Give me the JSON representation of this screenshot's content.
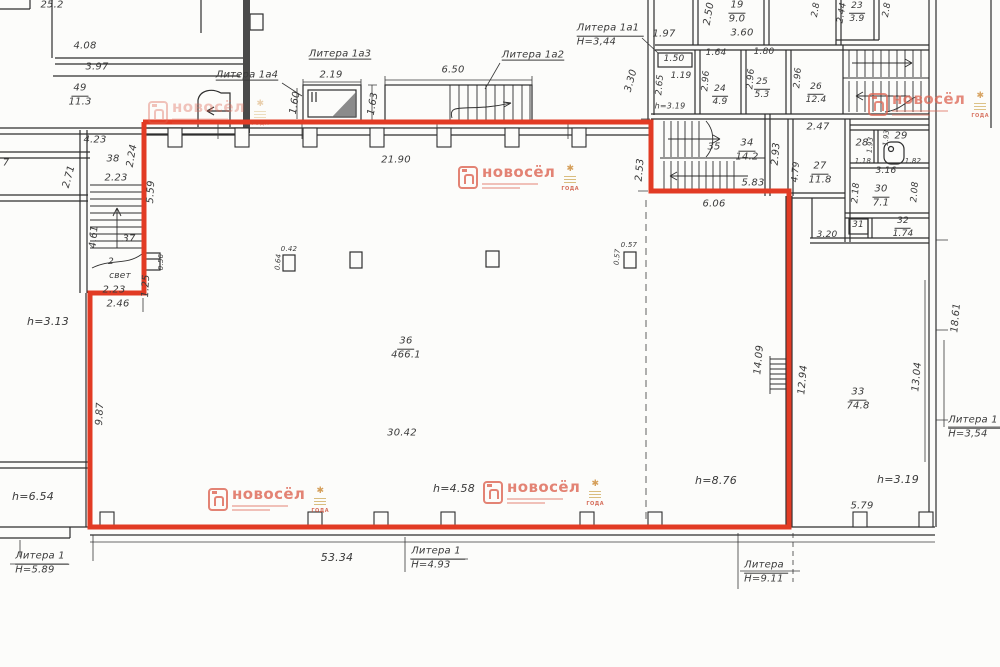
{
  "colors": {
    "red_outline": "#e23b24",
    "wall": "#2e2e2e",
    "watermark": "#dd6553",
    "badge_gold": "#c79b3b"
  },
  "watermark": {
    "brand": "новосёл",
    "badge": "ГОДА"
  },
  "labels": [
    {
      "text": "25.2",
      "x": 52,
      "y": 6
    },
    {
      "text": "4.08",
      "x": 85,
      "y": 47
    },
    {
      "text": "3.97",
      "x": 97,
      "y": 68
    },
    {
      "num": "49",
      "den": "11.3",
      "x": 80,
      "y": 96,
      "n": "room-area-label"
    },
    {
      "text": "4.23",
      "x": 95,
      "y": 141
    },
    {
      "text": "2.71",
      "x": 70,
      "y": 177,
      "r": -75
    },
    {
      "text": "7",
      "x": 6,
      "y": 164
    },
    {
      "text": "h=3.13",
      "x": 48,
      "y": 322,
      "s": 11,
      "n": "height-label"
    },
    {
      "text": "h=6.54",
      "x": 33,
      "y": 497,
      "s": 11,
      "n": "height-label"
    },
    {
      "num": "Литера 1",
      "den": "Н=5.89",
      "x": 42,
      "y": 564,
      "lit": true,
      "n": "litera-label"
    },
    {
      "text": "38",
      "x": 113,
      "y": 160,
      "n": "room-number"
    },
    {
      "text": "2.23",
      "x": 116,
      "y": 179
    },
    {
      "text": "2.24",
      "x": 133,
      "y": 156,
      "r": -80
    },
    {
      "text": "5.59",
      "x": 152,
      "y": 192,
      "r": -87
    },
    {
      "text": "4.61",
      "x": 95,
      "y": 237,
      "r": -85
    },
    {
      "text": "37",
      "x": 129,
      "y": 240,
      "n": "room-number"
    },
    {
      "text": "2",
      "x": 111,
      "y": 263,
      "s": 9
    },
    {
      "text": "свет",
      "x": 120,
      "y": 277,
      "s": 9
    },
    {
      "text": "2.23",
      "x": 114,
      "y": 291
    },
    {
      "text": "0.56",
      "x": 162,
      "y": 262,
      "r": -90,
      "s": 7
    },
    {
      "text": "1.25",
      "x": 147,
      "y": 286,
      "r": -87
    },
    {
      "text": "2.46",
      "x": 118,
      "y": 305
    },
    {
      "text": "9.87",
      "x": 101,
      "y": 414,
      "r": -87
    },
    {
      "text": "Литера 1а4",
      "x": 247,
      "y": 76,
      "u": true,
      "n": "litera-label"
    },
    {
      "text": "2.19",
      "x": 331,
      "y": 76
    },
    {
      "text": "1.60",
      "x": 296,
      "y": 103,
      "r": -80
    },
    {
      "text": "Литера 1а3",
      "x": 340,
      "y": 55,
      "u": true,
      "n": "litera-label"
    },
    {
      "text": "1.63",
      "x": 374,
      "y": 104,
      "r": -80
    },
    {
      "text": "6.50",
      "x": 453,
      "y": 71
    },
    {
      "text": "Литера 1а2",
      "x": 533,
      "y": 56,
      "u": true,
      "n": "litera-label"
    },
    {
      "text": "21.90",
      "x": 396,
      "y": 161
    },
    {
      "num": "Литера 1а1",
      "den": "Н=3,44",
      "x": 610,
      "y": 36,
      "lit": true,
      "n": "litera-label"
    },
    {
      "text": "1.97",
      "x": 664,
      "y": 35
    },
    {
      "text": "3.30",
      "x": 632,
      "y": 81,
      "r": -75
    },
    {
      "text": "2.50",
      "x": 710,
      "y": 14,
      "r": -80
    },
    {
      "num": "19",
      "den": "9.0",
      "x": 737,
      "y": 13,
      "n": "room-area-label"
    },
    {
      "text": "3.60",
      "x": 742,
      "y": 34
    },
    {
      "text": "2.8",
      "x": 817,
      "y": 10,
      "r": -80,
      "s": 9
    },
    {
      "text": "2.44",
      "x": 843,
      "y": 13,
      "r": -80,
      "s": 9
    },
    {
      "num": "23",
      "den": "3.9",
      "x": 857,
      "y": 13,
      "s": 9,
      "n": "room-area-label"
    },
    {
      "text": "2.8",
      "x": 888,
      "y": 10,
      "r": -80,
      "s": 9
    },
    {
      "text": "1.50",
      "x": 674,
      "y": 60,
      "s": 9
    },
    {
      "text": "1.19",
      "x": 681,
      "y": 77,
      "s": 9
    },
    {
      "text": "2.65",
      "x": 661,
      "y": 85,
      "r": -85,
      "s": 9
    },
    {
      "text": "h=3.19",
      "x": 670,
      "y": 107,
      "s": 8,
      "n": "height-label"
    },
    {
      "text": "1.64",
      "x": 716,
      "y": 54,
      "s": 9
    },
    {
      "text": "2.96",
      "x": 707,
      "y": 81,
      "r": -85,
      "s": 9
    },
    {
      "num": "24",
      "den": "4.9",
      "x": 720,
      "y": 96,
      "s": 9,
      "n": "room-area-label"
    },
    {
      "text": "1.80",
      "x": 764,
      "y": 53,
      "s": 9
    },
    {
      "text": "2.96",
      "x": 752,
      "y": 79,
      "r": -85,
      "s": 9
    },
    {
      "num": "25",
      "den": "5.3",
      "x": 762,
      "y": 89,
      "s": 9,
      "n": "room-area-label"
    },
    {
      "text": "2.96",
      "x": 799,
      "y": 78,
      "r": -85,
      "s": 9
    },
    {
      "num": "26",
      "den": "12.4",
      "x": 816,
      "y": 94,
      "s": 9,
      "n": "room-area-label"
    },
    {
      "text": "2.47",
      "x": 818,
      "y": 128
    },
    {
      "text": "35",
      "x": 714,
      "y": 148,
      "n": "room-number"
    },
    {
      "num": "34",
      "den": "14.2",
      "x": 747,
      "y": 151,
      "n": "room-area-label"
    },
    {
      "text": "2.93",
      "x": 777,
      "y": 154,
      "r": -85
    },
    {
      "text": "4.79",
      "x": 797,
      "y": 172,
      "r": -85,
      "s": 9
    },
    {
      "num": "27",
      "den": "11.8",
      "x": 820,
      "y": 174,
      "n": "room-area-label"
    },
    {
      "text": "5.83",
      "x": 753,
      "y": 184
    },
    {
      "text": "6.06",
      "x": 714,
      "y": 205
    },
    {
      "text": "28",
      "x": 862,
      "y": 144,
      "n": "room-number"
    },
    {
      "text": "1.93",
      "x": 871,
      "y": 145,
      "r": -85,
      "s": 7
    },
    {
      "text": "1.93",
      "x": 887,
      "y": 138,
      "r": -85,
      "s": 7
    },
    {
      "text": "29",
      "x": 901,
      "y": 137,
      "n": "room-number"
    },
    {
      "text": "1.18",
      "x": 863,
      "y": 162,
      "s": 7
    },
    {
      "text": "1.82",
      "x": 913,
      "y": 162,
      "s": 7
    },
    {
      "text": "3.16",
      "x": 886,
      "y": 172,
      "s": 9
    },
    {
      "text": "2.18",
      "x": 857,
      "y": 193,
      "r": -85,
      "s": 9
    },
    {
      "num": "30",
      "den": "7.1",
      "x": 881,
      "y": 197,
      "n": "room-area-label"
    },
    {
      "text": "2.08",
      "x": 916,
      "y": 192,
      "r": -85,
      "s": 9
    },
    {
      "text": "31",
      "x": 858,
      "y": 226,
      "s": 9,
      "n": "room-number"
    },
    {
      "num": "32",
      "den": "1.74",
      "x": 903,
      "y": 228,
      "s": 9,
      "n": "room-area-label"
    },
    {
      "text": "3.20",
      "x": 827,
      "y": 236,
      "s": 9
    },
    {
      "text": "18.61",
      "x": 957,
      "y": 318,
      "r": -85
    },
    {
      "text": "13.04",
      "x": 918,
      "y": 377,
      "r": -85
    },
    {
      "num": "33",
      "den": "74.8",
      "x": 858,
      "y": 400,
      "n": "room-area-label"
    },
    {
      "text": "14.09",
      "x": 760,
      "y": 360,
      "r": -85
    },
    {
      "text": "12.94",
      "x": 804,
      "y": 380,
      "r": -85
    },
    {
      "num": "Литера 1",
      "den": "Н=3,54",
      "x": 975,
      "y": 428,
      "lit": true,
      "n": "litera-label"
    },
    {
      "text": "h=3.19",
      "x": 898,
      "y": 480,
      "s": 11,
      "n": "height-label"
    },
    {
      "text": "5.79",
      "x": 862,
      "y": 507
    },
    {
      "text": "h=8.76",
      "x": 716,
      "y": 481,
      "s": 11,
      "n": "height-label"
    },
    {
      "num": "36",
      "den": "466.1",
      "x": 406,
      "y": 349,
      "n": "room-area-label"
    },
    {
      "text": "30.42",
      "x": 402,
      "y": 434
    },
    {
      "text": "h=4.58",
      "x": 454,
      "y": 489,
      "s": 11,
      "n": "height-label"
    },
    {
      "text": "0.42",
      "x": 289,
      "y": 250,
      "s": 7
    },
    {
      "text": "0.64",
      "x": 279,
      "y": 262,
      "r": -85,
      "s": 7
    },
    {
      "text": "0.57",
      "x": 629,
      "y": 246,
      "s": 7
    },
    {
      "text": "0.57",
      "x": 618,
      "y": 257,
      "r": -85,
      "s": 7
    },
    {
      "text": "53.34",
      "x": 337,
      "y": 558,
      "s": 11
    },
    {
      "num": "Литера 1",
      "den": "Н=4.93",
      "x": 438,
      "y": 559,
      "lit": true,
      "n": "litera-label"
    },
    {
      "num": "Литера",
      "den": "Н=9.11",
      "x": 766,
      "y": 573,
      "lit": true,
      "n": "litera-label"
    },
    {
      "text": "2.53",
      "x": 641,
      "y": 170,
      "r": -85
    }
  ]
}
